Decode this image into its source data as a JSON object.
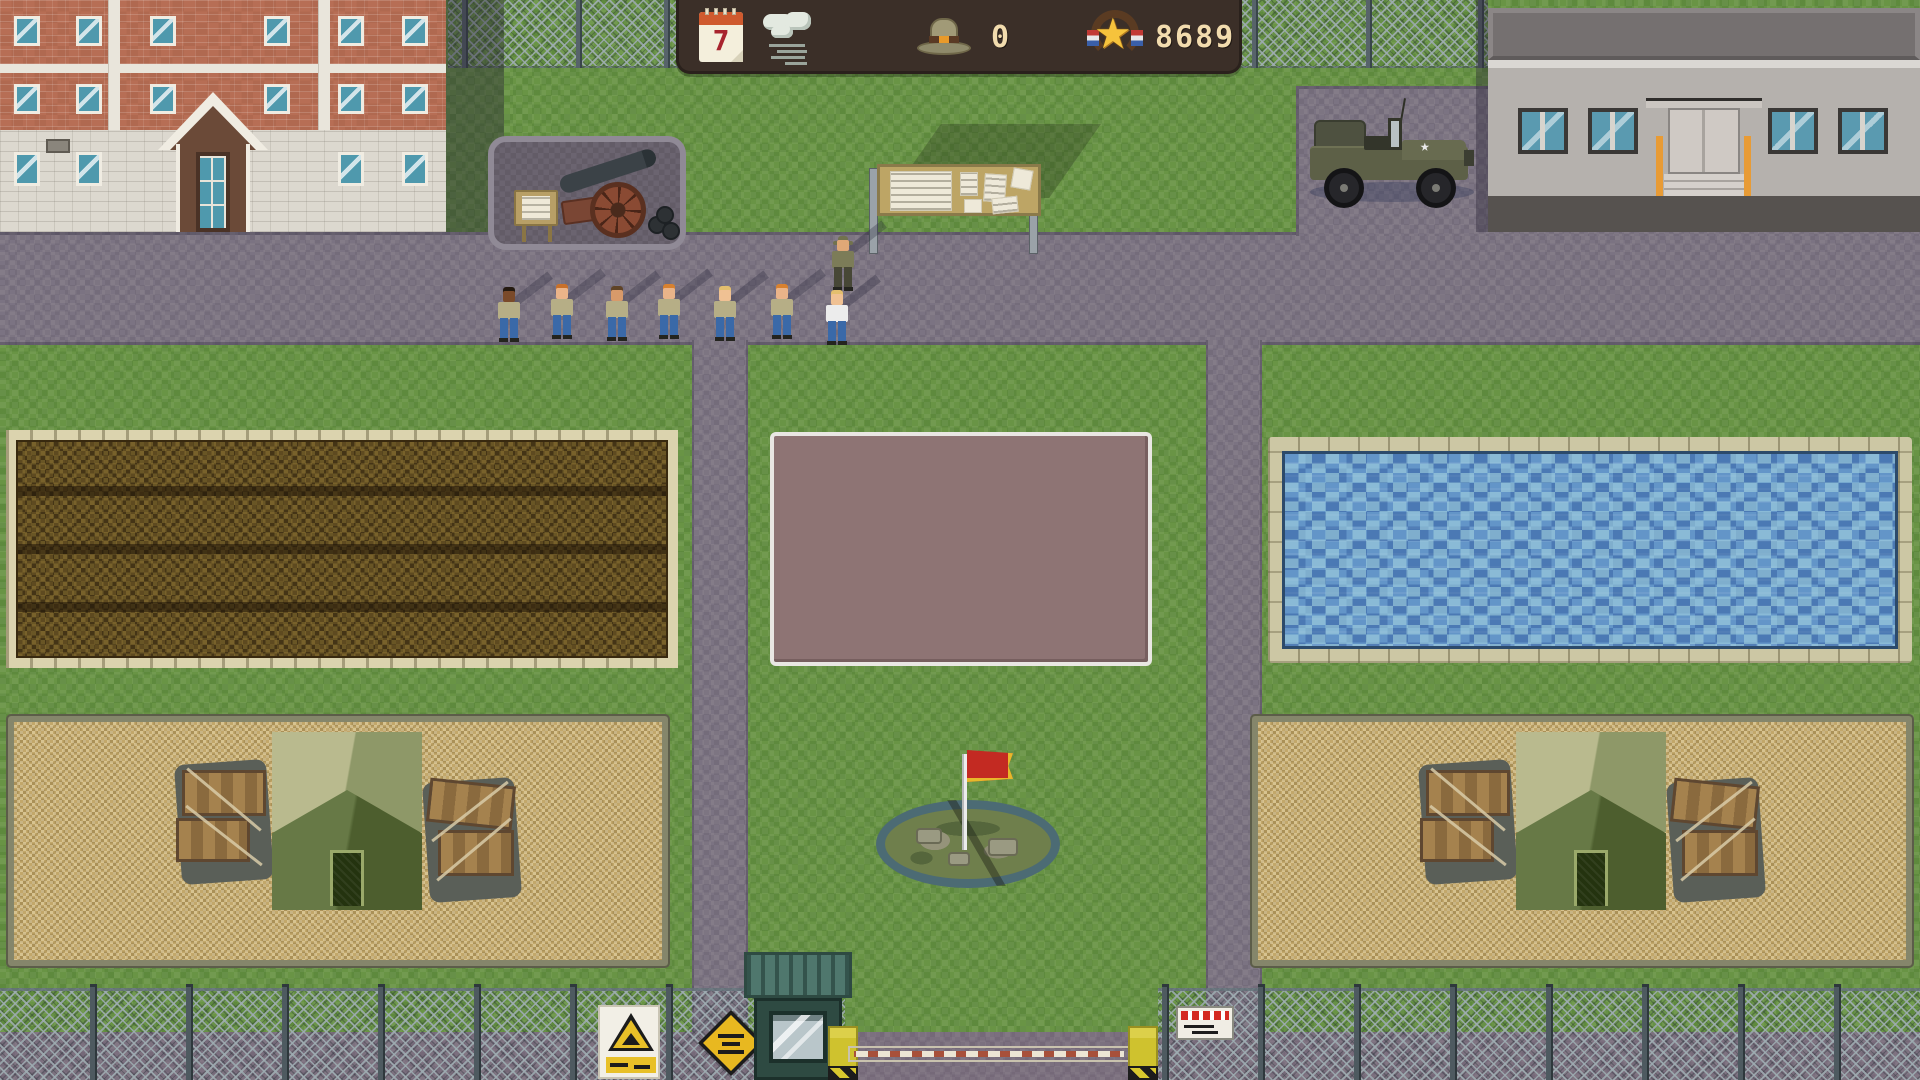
{
  "hud": {
    "day": "7",
    "recruits": "0",
    "score": "8689",
    "colors": {
      "bar_bg": "#3b2f28",
      "text": "#f2dcae",
      "accent_gold": "#f6c33c"
    }
  },
  "flag": {
    "color": "#c32a22",
    "trim": "#e8b82a"
  },
  "people": [
    {
      "role": "drill-sergeant",
      "x": 830,
      "y": 236,
      "skin": "#e0a877",
      "shirt": "#7c7c58",
      "pants": "#474736",
      "hat": "#72724e"
    },
    {
      "role": "recruit",
      "x": 496,
      "y": 287,
      "skin": "#7a4a2a",
      "hair": "#241a10",
      "shirt": "#b6ae86",
      "pants": "#3a69a8"
    },
    {
      "role": "recruit",
      "x": 549,
      "y": 284,
      "skin": "#eab489",
      "hair": "#c8702a",
      "shirt": "#b6ae86",
      "pants": "#3a69a8"
    },
    {
      "role": "recruit",
      "x": 604,
      "y": 286,
      "skin": "#d89a6a",
      "hair": "#5f4326",
      "shirt": "#b6ae86",
      "pants": "#3a69a8"
    },
    {
      "role": "recruit",
      "x": 656,
      "y": 284,
      "skin": "#eab489",
      "hair": "#d8812f",
      "shirt": "#b6ae86",
      "pants": "#3a69a8"
    },
    {
      "role": "recruit",
      "x": 712,
      "y": 286,
      "skin": "#f0c193",
      "hair": "#e4bf6e",
      "shirt": "#b6ae86",
      "pants": "#3a69a8"
    },
    {
      "role": "recruit",
      "x": 769,
      "y": 284,
      "skin": "#eab489",
      "hair": "#d8812f",
      "shirt": "#b6ae86",
      "pants": "#3a69a8"
    },
    {
      "role": "recruit",
      "x": 824,
      "y": 290,
      "skin": "#f0c193",
      "hair": "#e4bf6e",
      "shirt": "#ececec",
      "pants": "#3a69a8"
    }
  ]
}
